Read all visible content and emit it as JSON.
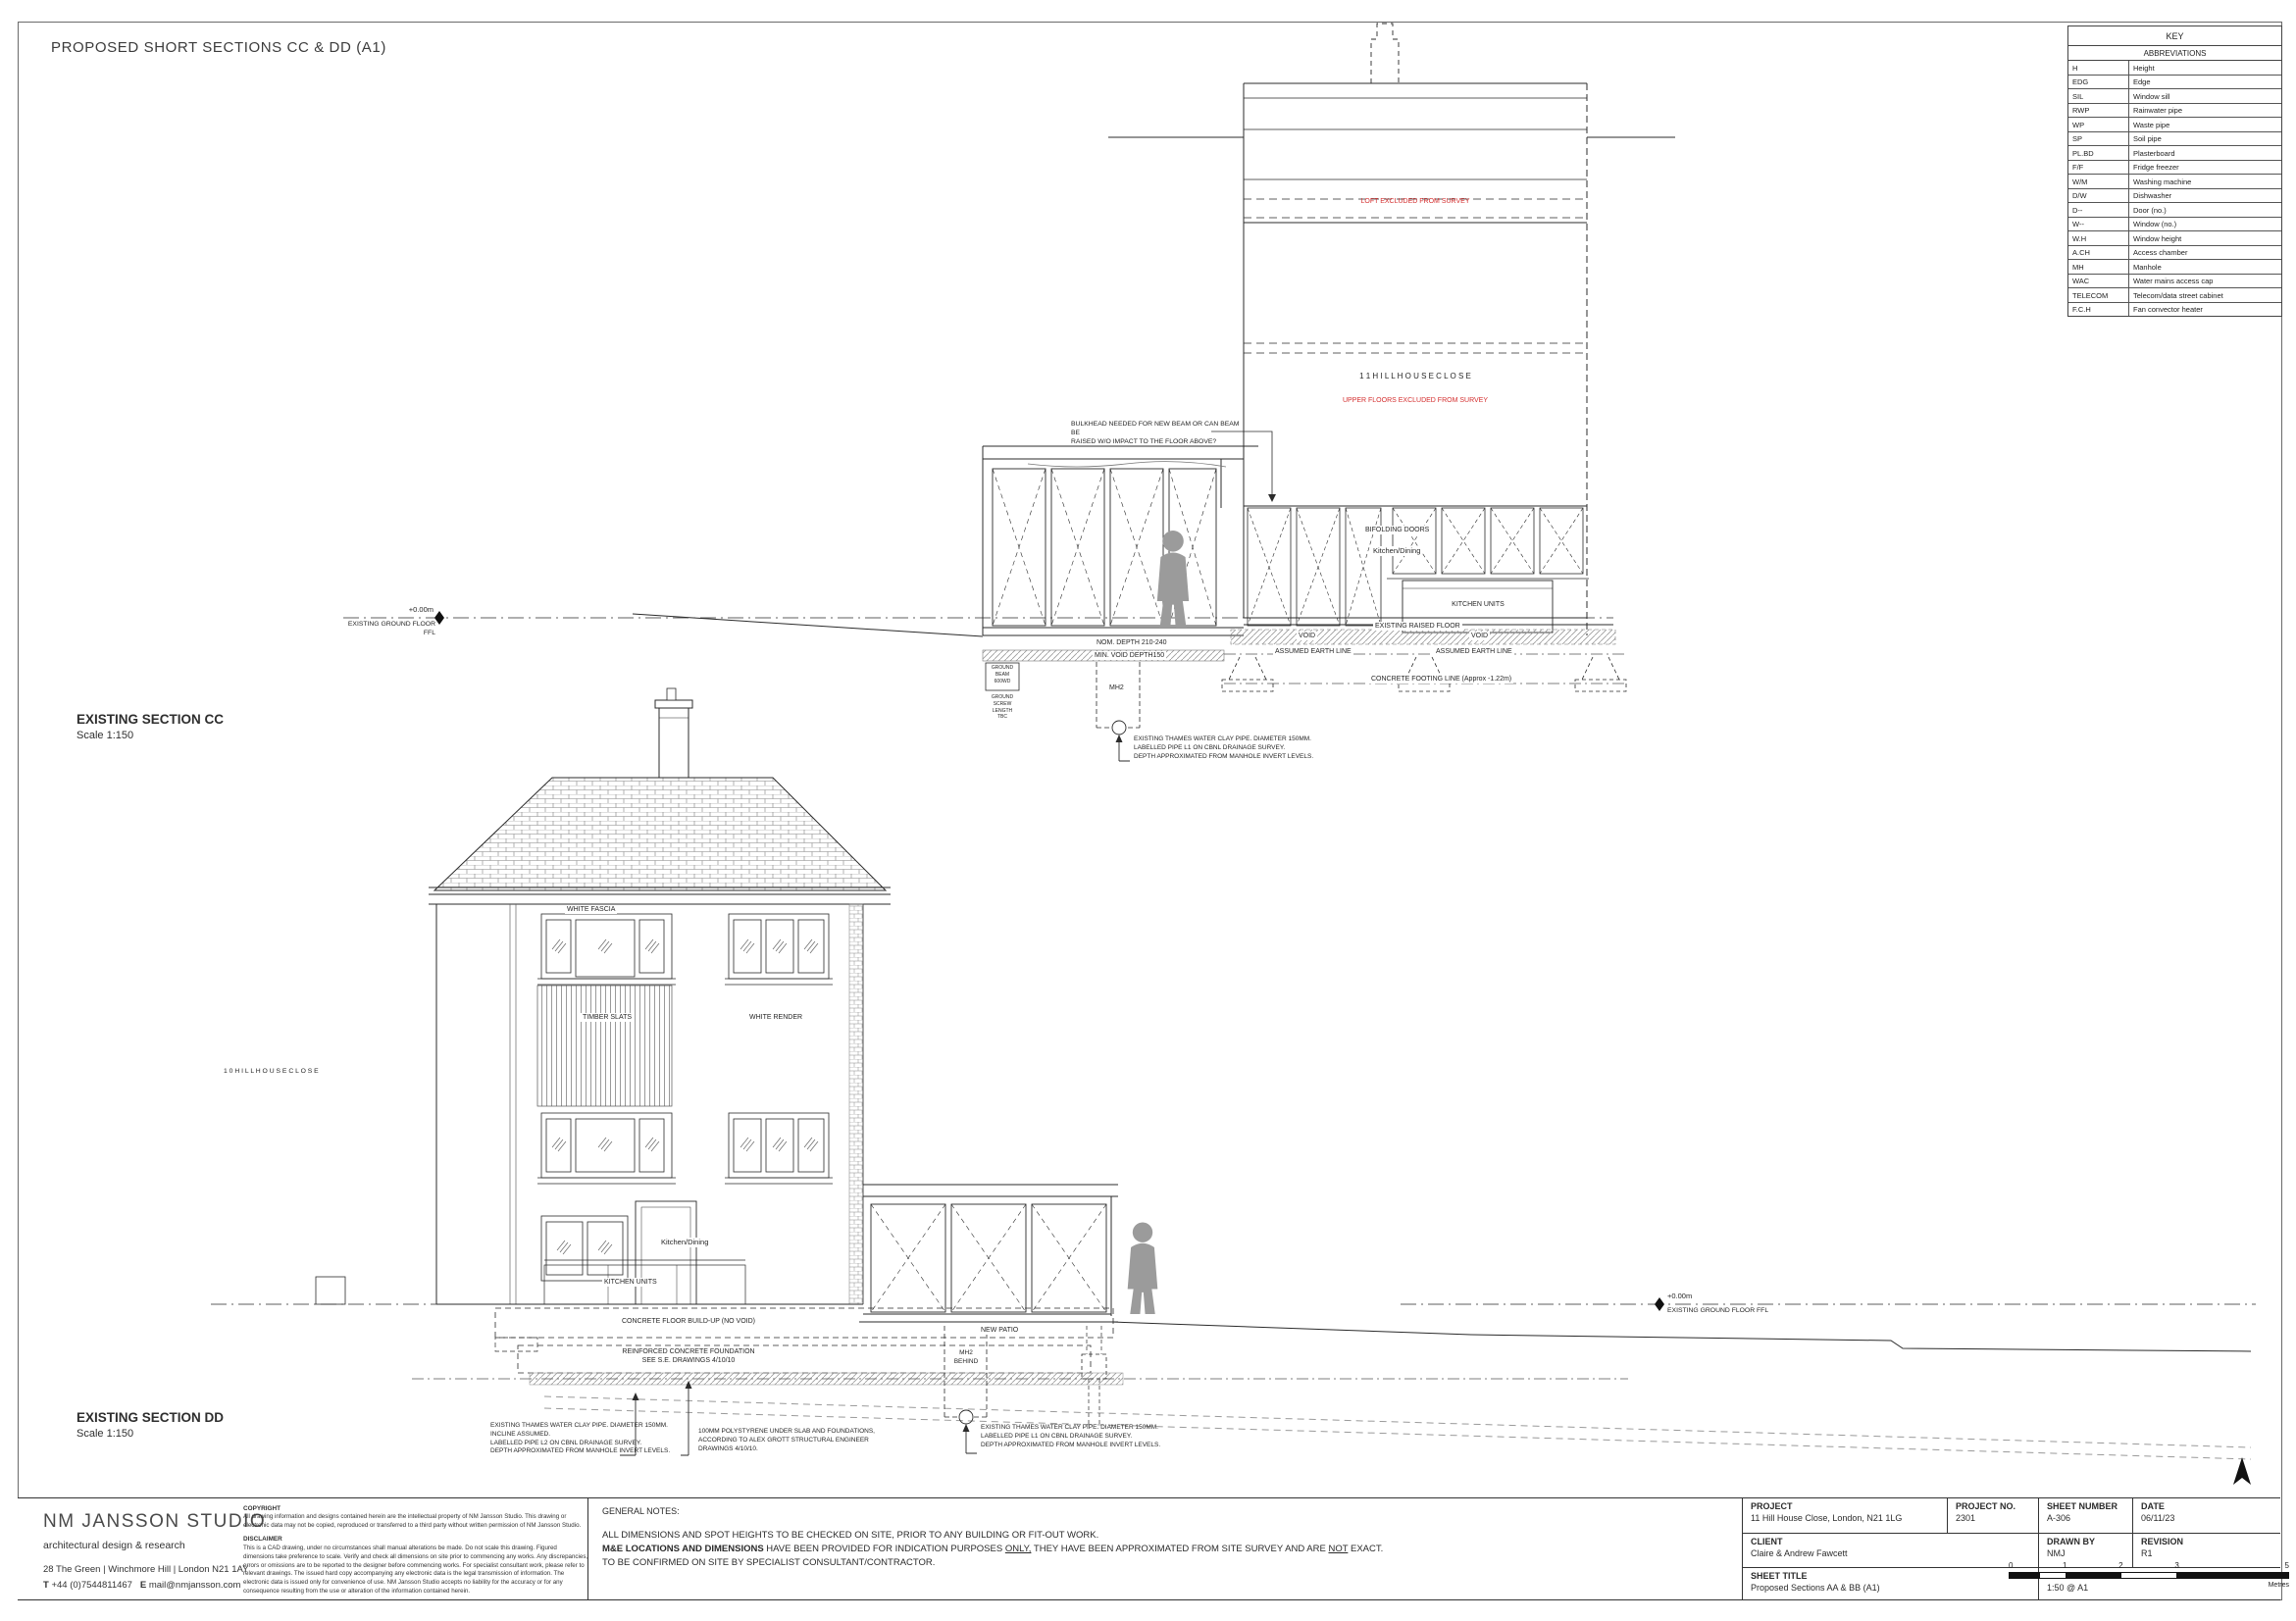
{
  "sheet": {
    "title": "PROPOSED SHORT SECTIONS CC & DD (A1)"
  },
  "colors": {
    "annotation_red": "#d42f2f",
    "line": "#2b2b2b"
  },
  "key": {
    "title": "KEY",
    "subtitle": "ABBREVIATIONS",
    "rows": [
      [
        "H",
        "Height"
      ],
      [
        "EDG",
        "Edge"
      ],
      [
        "SIL",
        "Window sill"
      ],
      [
        "RWP",
        "Rainwater pipe"
      ],
      [
        "WP",
        "Waste pipe"
      ],
      [
        "SP",
        "Soil pipe"
      ],
      [
        "PL.BD",
        "Plasterboard"
      ],
      [
        "F/F",
        "Fridge freezer"
      ],
      [
        "W/M",
        "Washing machine"
      ],
      [
        "D/W",
        "Dishwasher"
      ],
      [
        "D--",
        "Door (no.)"
      ],
      [
        "W--",
        "Window (no.)"
      ],
      [
        "W.H",
        "Window height"
      ],
      [
        "A.CH",
        "Access chamber"
      ],
      [
        "MH",
        "Manhole"
      ],
      [
        "WAC",
        "Water mains access cap"
      ],
      [
        "TELECOM",
        "Telecom/data street cabinet"
      ],
      [
        "F.C.H",
        "Fan convector heater"
      ]
    ]
  },
  "section_cc": {
    "heading": "EXISTING SECTION CC",
    "scale": "Scale 1:150",
    "labels": {
      "loft_note": "LOFT EXCLUDED FROM SURVEY",
      "house_name": "1 1   H I L L   H O U S E   C L O S E",
      "upper_note": "UPPER FLOORS EXCLUDED FROM SURVEY",
      "bulkhead_note": "BULKHEAD NEEDED FOR NEW BEAM OR CAN BEAM BE\nRAISED W/O IMPACT TO THE FLOOR ABOVE?",
      "datum_value": "+0.00m",
      "datum_label": "EXISTING GROUND FLOOR FFL",
      "bifolding_doors": "BIFOLDING DOORS",
      "kitchen_dining": "Kitchen/Dining",
      "kitchen_units": "KITCHEN UNITS",
      "existing_raised_floor": "EXISTING RAISED FLOOR",
      "void_left": "VOID",
      "void_right": "VOID",
      "assumed_earth_left": "ASSUMED EARTH LINE",
      "assumed_earth_right": "ASSUMED EARTH LINE",
      "footing_line": "CONCRETE FOOTING LINE (Approx -1.22m)",
      "nom_depth": "NOM. DEPTH 210-240",
      "min_void_depth": "MIN. VOID DEPTH150",
      "ground_beam": "GROUND\nBEAM\n600WD",
      "ground_screw": "GROUND\nSCREW\nLENGTH\nTBC",
      "mh2": "MH2",
      "pipe_note": "EXISTING THAMES WATER CLAY PIPE. DIAMETER 150MM.\nLABELLED PIPE L1 ON CBNL DRAINAGE SURVEY.\nDEPTH APPROXIMATED FROM MANHOLE INVERT LEVELS."
    }
  },
  "section_dd": {
    "heading": "EXISTING SECTION DD",
    "scale": "Scale 1:150",
    "labels": {
      "neighbour_house": "1 0   H I L L   H O U S E   C L O S E",
      "white_fascia": "WHITE FASCIA",
      "timber_slats": "TIMBER SLATS",
      "white_render": "WHITE RENDER",
      "kitchen_dining": "Kitchen/Dining",
      "kitchen_units": "KITCHEN UNITS",
      "concrete_floor": "CONCRETE FLOOR BUILD-UP (NO VOID)",
      "rc_foundation": "REINFORCED CONCRETE FOUNDATION\nSEE S.E. DRAWINGS 4/10/10",
      "pipe_l2_note": "EXISTING THAMES WATER CLAY PIPE. DIAMETER 150MM.\nINCLINE ASSUMED.\nLABELLED PIPE L2 ON CBNL DRAINAGE SURVEY.\nDEPTH APPROXIMATED FROM MANHOLE INVERT LEVELS.",
      "polystyrene_note": "100MM POLYSTYRENE UNDER SLAB AND FOUNDATIONS,\nACCORDING TO ALEX GROTT STRUCTURAL ENGINEER\nDRAWINGS 4/10/10.",
      "new_patio": "NEW PATIO",
      "mh2_behind": "MH2\nBEHIND",
      "pipe_l1_note": "EXISTING THAMES WATER CLAY PIPE. DIAMETER 150MM.\nLABELLED PIPE L1 ON CBNL DRAINAGE SURVEY.\nDEPTH APPROXIMATED FROM MANHOLE INVERT LEVELS.",
      "datum_value": "+0.00m",
      "datum_label": "EXISTING GROUND FLOOR FFL"
    }
  },
  "title_block": {
    "studio": {
      "name": "NM JANSSON STUDIO",
      "tagline": "architectural design & research",
      "address": "28 The Green | Winchmore Hill | London N21 1AY",
      "phone_label": "T",
      "phone": "+44 (0)7544811467",
      "email_label": "E",
      "email": "mail@nmjansson.com"
    },
    "copyright": {
      "heading": "COPYRIGHT",
      "body": "All drawing information and designs contained herein are the intellectual property of NM Jansson Studio. This drawing or electronic data may not be copied, reproduced or transferred to a third party without written permission of NM Jansson Studio."
    },
    "disclaimer": {
      "heading": "DISCLAIMER",
      "body": "This is a CAD drawing, under no circumstances shall manual alterations be made. Do not scale this drawing. Figured dimensions take preference to scale. Verify and check all dimensions on site prior to commencing any works. Any discrepancies, errors or omissions are to be reported to the designer before commencing works. For specialist consultant work, please refer to relevant drawings. The issued hard copy accompanying any electronic data is the legal transmission of information. The electronic data is issued only for convenience of use. NM Jansson Studio accepts no liability for the accuracy or for any consequence resulting from the use or alteration of the information contained herein."
    },
    "general_notes": {
      "heading": "GENERAL NOTES:",
      "line1": "ALL DIMENSIONS AND SPOT HEIGHTS TO BE CHECKED ON SITE, PRIOR TO ANY BUILDING OR FIT-OUT WORK.",
      "m_and_e_bold": "M&E LOCATIONS AND DIMENSIONS",
      "seg1": " HAVE BEEN PROVIDED FOR INDICATION PURPOSES ",
      "only_underlined": "ONLY,",
      "seg2": " THEY HAVE BEEN APPROXIMATED FROM SITE SURVEY AND ARE ",
      "not_underlined": "NOT",
      "seg3": " EXACT. TO BE CONFIRMED ON SITE BY SPECIALIST CONSULTANT/CONTRACTOR."
    },
    "scale_bar": {
      "ticks": [
        "0",
        "1",
        "2",
        "3",
        "5"
      ],
      "unit": "Metres"
    },
    "project": {
      "project_label": "PROJECT",
      "project": "11 Hill House Close, London, N21 1LG",
      "project_no_label": "PROJECT NO.",
      "project_no": "2301",
      "sheet_number_label": "SHEET NUMBER",
      "sheet_number": "A-306",
      "date_label": "DATE",
      "date": "06/11/23",
      "client_label": "CLIENT",
      "client": "Claire & Andrew Fawcett",
      "drawn_by_label": "DRAWN BY",
      "drawn_by": "NMJ",
      "revision_label": "REVISION",
      "revision": "R1",
      "sheet_title_label": "SHEET TITLE",
      "sheet_title": "Proposed Sections AA & BB (A1)",
      "scale_label": "SCALE",
      "scale": "1:50 @ A1"
    }
  }
}
